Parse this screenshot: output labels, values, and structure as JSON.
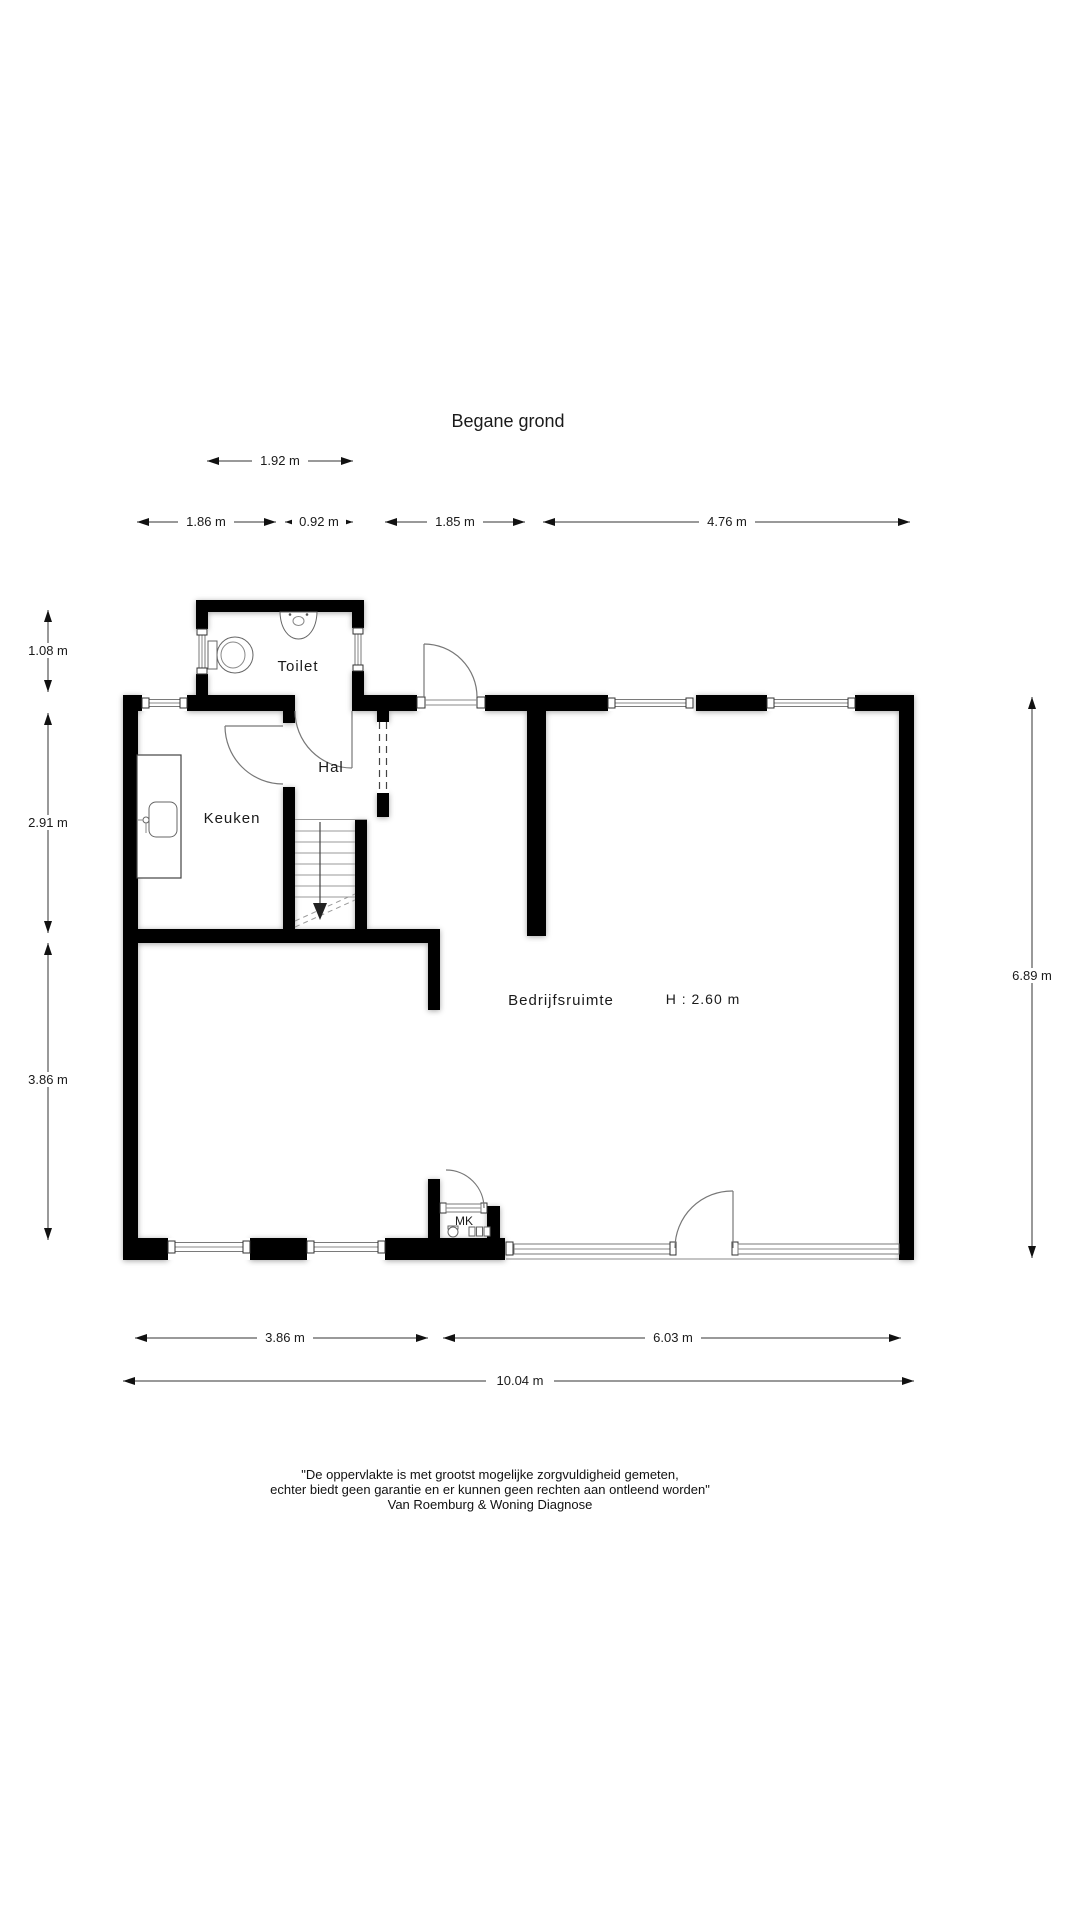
{
  "title": "Begane grond",
  "rooms": {
    "toilet": "Toilet",
    "hal": "Hal",
    "keuken": "Keuken",
    "bedrijfsruimte": "Bedrijfsruimte",
    "bedrijfsruimte_height": "H : 2.60 m",
    "meterkast": "MK"
  },
  "dimensions": {
    "toilet_width": "1.92 m",
    "keuken_width": "1.86 m",
    "hal_width": "0.92 m",
    "mid_width": "1.85 m",
    "right_width": "4.76 m",
    "toilet_depth": "1.08 m",
    "keuken_depth": "2.91 m",
    "lower_depth": "3.86 m",
    "total_depth": "6.89 m",
    "bottom_left_width": "3.86 m",
    "bottom_right_width": "6.03 m",
    "total_width": "10.04 m"
  },
  "disclaimer": {
    "line1": "\"De oppervlakte is met grootst mogelijke zorgvuldigheid gemeten,",
    "line2": "echter biedt geen garantie en er kunnen geen rechten aan ontleend worden\"",
    "line3": "Van Roemburg & Woning Diagnose"
  },
  "colors": {
    "wall": "#000000",
    "fixture_line": "#666666",
    "text": "#1a1a1a"
  }
}
